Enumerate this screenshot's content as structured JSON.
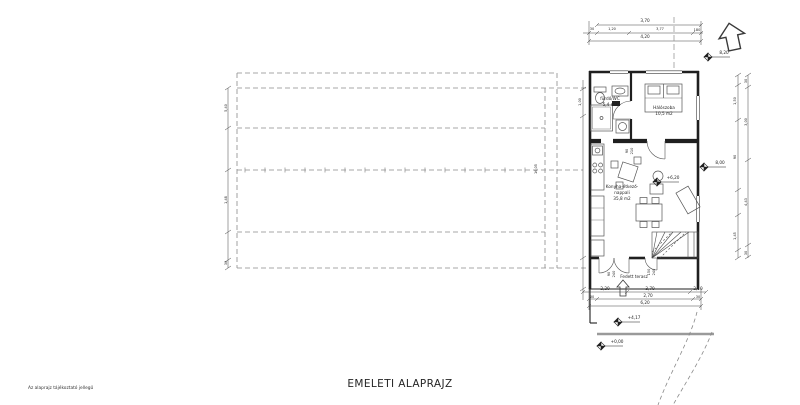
{
  "title": "EMELETI ALAPRAJZ",
  "footnote": "Az alaprajz tájékoztató jellegű",
  "rooms": {
    "bath": {
      "name": "fürdő/WC",
      "area": "5,4 m2"
    },
    "bedroom": {
      "name": "Hálószoba",
      "area": "10,5 m2"
    },
    "living": {
      "name1": "Konyha-étkező-",
      "name2": "nappali",
      "area": "35,8 m2"
    },
    "terrace": {
      "name": "Fedett terasz"
    }
  },
  "levels": {
    "roof": "8,20",
    "eaves": "8,00",
    "floor": "+6,20",
    "terrace": "+4,17",
    "ground": "+0,00"
  },
  "dims": {
    "top": {
      "span": "3,70",
      "a": "30",
      "b": "1,20",
      "c": "3,77",
      "d": "180",
      "total": "4,20"
    },
    "bottom": {
      "a": "2,20",
      "b": "3,70",
      "c": "2,10",
      "d": "30",
      "e": "2,70",
      "f": "30",
      "total": "6,20"
    },
    "right": {
      "a": "30",
      "b": "1,50",
      "c": "3,00",
      "d": "90",
      "e": "4,43",
      "f": "1,45",
      "g": "30"
    },
    "left": {
      "a": "5,40",
      "b": "1,48",
      "c": "30",
      "d": "1,00",
      "len": "16,05"
    },
    "doors": {
      "a1": "90",
      "a2": "240",
      "b1": "150",
      "b2": "240",
      "c1": "90",
      "c2": "210"
    }
  },
  "colors": {
    "wall": "#1f1f1f",
    "line": "#444444",
    "dash": "#8a8a8a",
    "text": "#1f1f1f"
  }
}
